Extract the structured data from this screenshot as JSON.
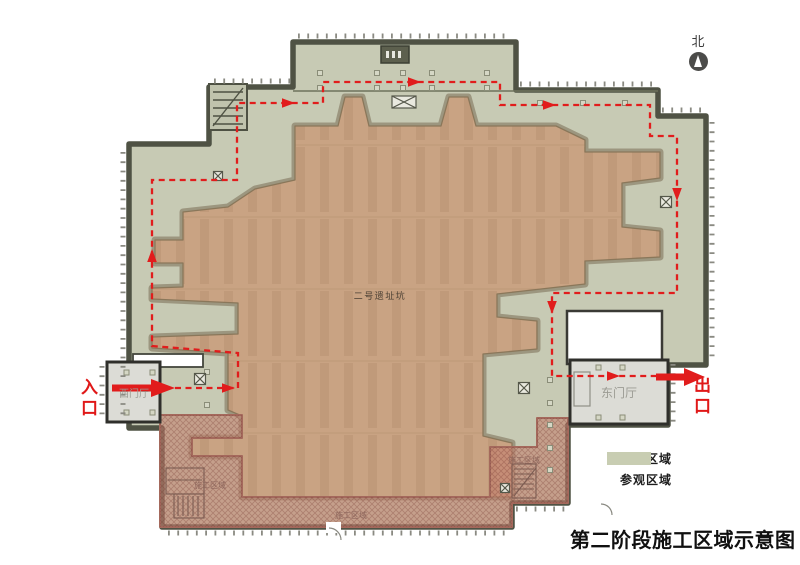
{
  "title": "第二阶段施工区域示意图",
  "compass": {
    "label": "北"
  },
  "plan": {
    "pit_label": "二号遗址坑",
    "west_lobby_label": "西门厅",
    "east_lobby_label": "东门厅",
    "entrance_label": "入口",
    "exit_label": "出口",
    "construction_zone_label": "施工区域"
  },
  "legend": {
    "items": [
      {
        "label": "施工区域",
        "color": "#d7a094"
      },
      {
        "label": "参观区域",
        "color": "#c8cdb2"
      }
    ]
  },
  "colors": {
    "visit_area": "#c7cab4",
    "pit": "#c9a383",
    "construction_area": "#c5806f",
    "wall": "#4f5244",
    "route": "#e11c1c"
  }
}
